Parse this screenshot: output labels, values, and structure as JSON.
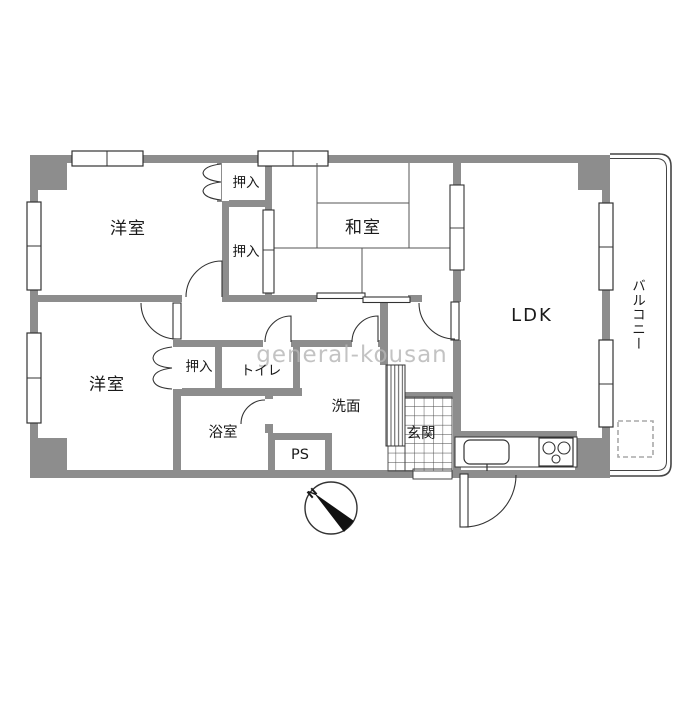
{
  "floorplan": {
    "watermark": "general-kousan",
    "compass_north": "N",
    "rooms": {
      "western_room_top": "洋室",
      "japanese_room": "和室",
      "ldk": "LDK",
      "balcony": "バルコニー",
      "closet_top": "押入",
      "closet_mid": "押入",
      "western_room_bottom": "洋室",
      "closet_bottom": "押入",
      "toilet": "トイレ",
      "bathroom": "浴室",
      "washroom": "洗面",
      "pipe_space": "PS",
      "entrance": "玄関"
    },
    "colors": {
      "wall": "#8d8d8d",
      "line": "#333333",
      "watermark": "#b5b5b5"
    }
  }
}
